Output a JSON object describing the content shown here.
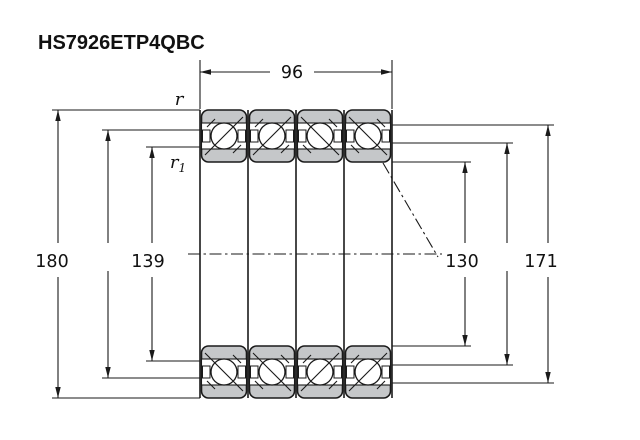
{
  "title": "HS7926ETP4QBC",
  "dimensions": {
    "width": "96",
    "outer_diameter": "180",
    "inner_shoulder": "139",
    "bore": "130",
    "outer_shoulder": "171"
  },
  "labels": {
    "r": "r",
    "r1_base": "r",
    "r1_sub": "1"
  },
  "colors": {
    "ring_fill": "#c5c7c9",
    "line_color": "#1a1a1a",
    "bg": "#ffffff",
    "text_color": "#111111"
  }
}
